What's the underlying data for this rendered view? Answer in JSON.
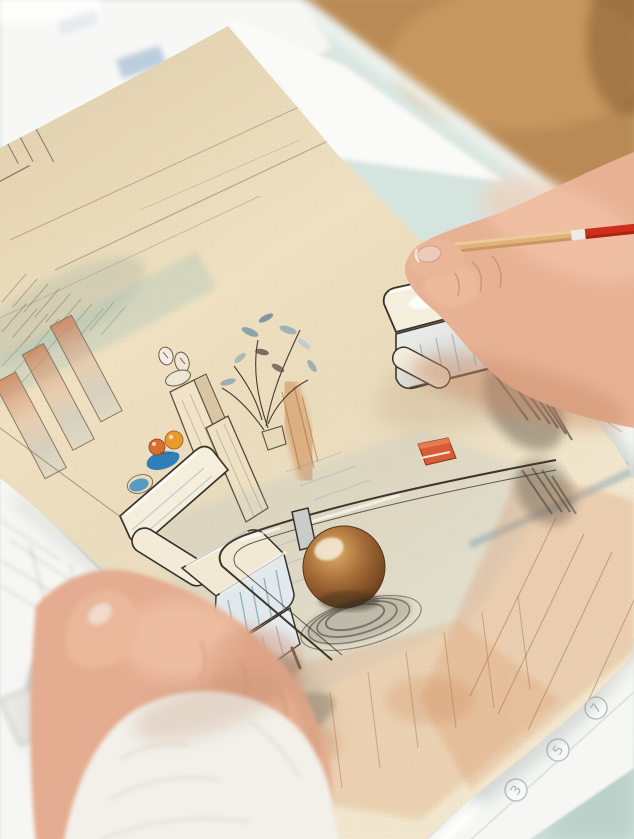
{
  "scene": {
    "type": "photograph",
    "description": "Two hands hold a cream textured sheet with a colored-pencil and watercolor interior sketch of a living room (two pale armchairs, glass coffee table on a round wooden base, window wall, plant, fruit bowls). The right hand holds a red-tipped wooden pencil. Beneath lie blurred white plan sheets with circled markers, on a pale mint desk; a warm wooden floor is blurred in the top-right."
  },
  "colors": {
    "desk": "#cfdfda",
    "desk_shadow": "#b7cdc6",
    "wood_background": "#b98a54",
    "table_edge": "#f0f4f1",
    "underlay_paper": "#f7f8f6",
    "plan_paper": "#f6f7f5",
    "sketch_paper": "#efe1c2",
    "line_ink": "#3e362c",
    "wash_teal": "#a4c4b8",
    "wash_blue": "#9db8c6",
    "wash_orange": "#d8956a",
    "bowl_blue": "#2f80b8",
    "fruit_orange": "#e89a2c",
    "fruit_red": "#d96f2e",
    "table_base_brown": "#9c6434",
    "charcoal": "#474034",
    "pencil_wood": "#e2b27c",
    "pencil_band": "#eceae6",
    "pencil_red": "#cf2f1a",
    "skin": "#e7b194",
    "skin_left": "#e4ac90",
    "nail": "#eecab8",
    "sleeve": "#f2f0e9"
  },
  "plan_paper": {
    "markers": [
      "3",
      "5",
      "7"
    ]
  }
}
